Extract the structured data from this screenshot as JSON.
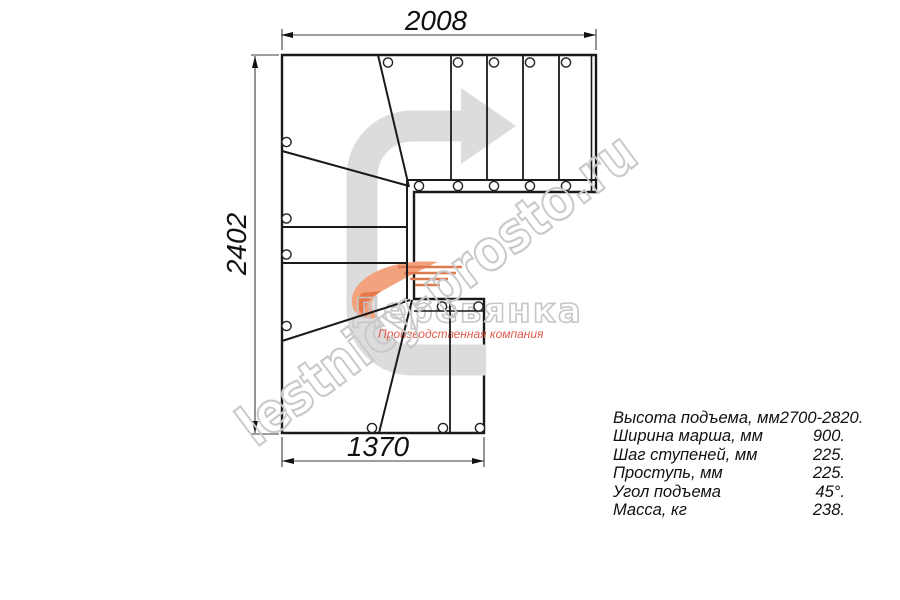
{
  "drawing": {
    "dimensions": {
      "top": "2008",
      "left": "2402",
      "bottom": "1370"
    },
    "watermark": {
      "text": "lestnicy-prosto.ru"
    },
    "logo": {
      "name": "Деревянка",
      "tagline": "Производственная компания"
    },
    "specs": {
      "rows": [
        {
          "label": "Высота подъема, мм",
          "value": "2700-2820."
        },
        {
          "label": "Ширина марша, мм",
          "value": "900."
        },
        {
          "label": "Шаг ступеней, мм",
          "value": "225."
        },
        {
          "label": "Проступь, мм",
          "value": "225."
        },
        {
          "label": "Угол подъема",
          "value": "45°."
        },
        {
          "label": "Масса, кг",
          "value": "238."
        }
      ]
    },
    "colors": {
      "line": "#1a1a1a",
      "arrow_gray": "#dcdcdc",
      "watermark_gray": "#c9c9c9",
      "logo_orange": "#ee8a58",
      "logo_red": "#e05a4a"
    }
  }
}
